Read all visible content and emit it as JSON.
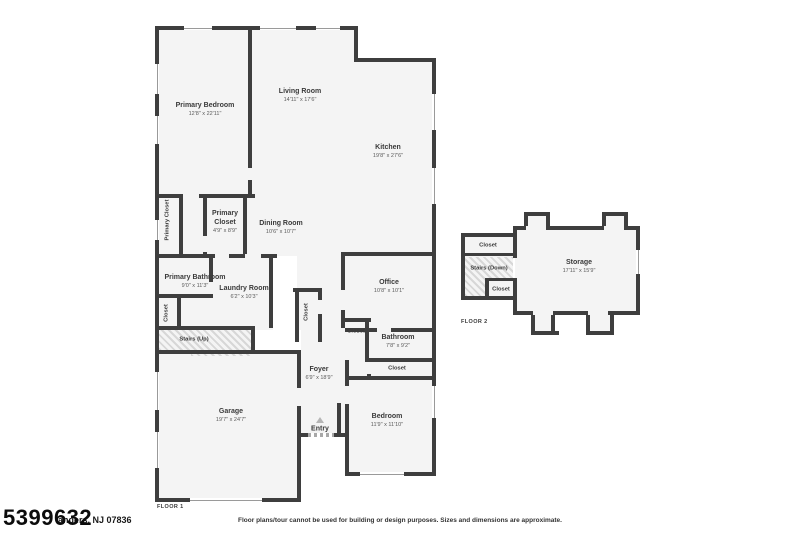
{
  "colors": {
    "wall": "#3e3e3e",
    "room_fill": "#f4f4f4",
    "background": "#ffffff",
    "label_text": "#3a3a3a",
    "dim_text": "#5a5a5a"
  },
  "floor1": {
    "label": "FLOOR 1",
    "rooms": {
      "primary_bedroom": {
        "name": "Primary Bedroom",
        "dims": "12'8\" x 22'11\""
      },
      "living_room": {
        "name": "Living Room",
        "dims": "14'11\" x 17'6\""
      },
      "kitchen": {
        "name": "Kitchen",
        "dims": "19'8\" x 27'6\""
      },
      "primary_closet_left": {
        "name": "Primary Closet"
      },
      "primary_closet": {
        "name": "Primary Closet",
        "dims": "4'9\" x 8'9\""
      },
      "dining_room": {
        "name": "Dining Room",
        "dims": "10'6\" x 10'7\""
      },
      "primary_bathroom": {
        "name": "Primary Bathroom",
        "dims": "9'0\" x 11'3\""
      },
      "laundry_room": {
        "name": "Laundry Room",
        "dims": "6'2\" x 10'3\""
      },
      "closet_hall": {
        "name": "Closet"
      },
      "stairs_up": {
        "name": "Stairs (Up)"
      },
      "office": {
        "name": "Office",
        "dims": "10'8\" x 10'1\""
      },
      "closet_office": {
        "name": "Closet"
      },
      "bathroom": {
        "name": "Bathroom",
        "dims": "7'8\" x 9'2\""
      },
      "closet_bedroom": {
        "name": "Closet"
      },
      "closet_foyer": {
        "name": "Closet"
      },
      "foyer": {
        "name": "Foyer",
        "dims": "6'9\" x 18'9\""
      },
      "entry": {
        "name": "Entry"
      },
      "garage": {
        "name": "Garage",
        "dims": "19'7\" x 24'7\""
      },
      "bedroom": {
        "name": "Bedroom",
        "dims": "11'9\" x 11'10\""
      }
    }
  },
  "floor2": {
    "label": "FLOOR 2",
    "rooms": {
      "closet_top": {
        "name": "Closet"
      },
      "stairs_down": {
        "name": "Stairs (Down)"
      },
      "closet_small": {
        "name": "Closet"
      },
      "storage": {
        "name": "Storage",
        "dims": "17'11\" x 15'9\""
      }
    }
  },
  "footer": {
    "mls_number": "5399632",
    "address_fragment": "anders, NJ 07836",
    "disclaimer": "Floor plans/tour cannot be used for building or design purposes. Sizes and dimensions are approximate."
  }
}
